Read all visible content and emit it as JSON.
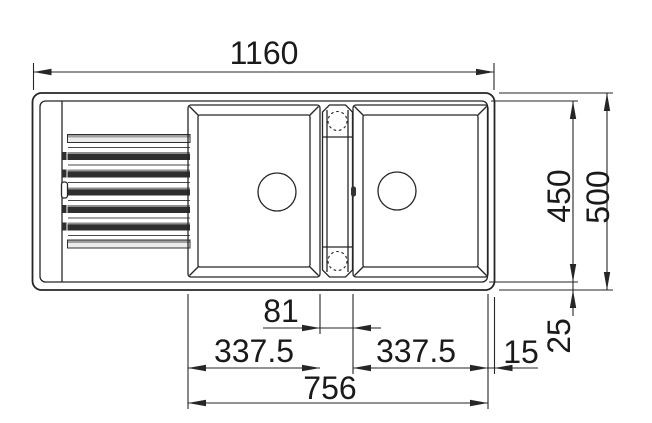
{
  "colors": {
    "line": "#262626",
    "text": "#1a1a1a",
    "background": "#ffffff",
    "rib_dark": "#2e2e2e",
    "rib_highlight": "#8e8e8e",
    "rib_light": "#ececec"
  },
  "dimensions": {
    "overall_width": "1160",
    "inner_depth": "450",
    "overall_depth": "500",
    "center_gap": "81",
    "left_bowl_width": "337.5",
    "right_bowl_width": "337.5",
    "bowls_total_width": "756",
    "edge_offset_side": "15",
    "edge_offset_bottom": "25"
  }
}
